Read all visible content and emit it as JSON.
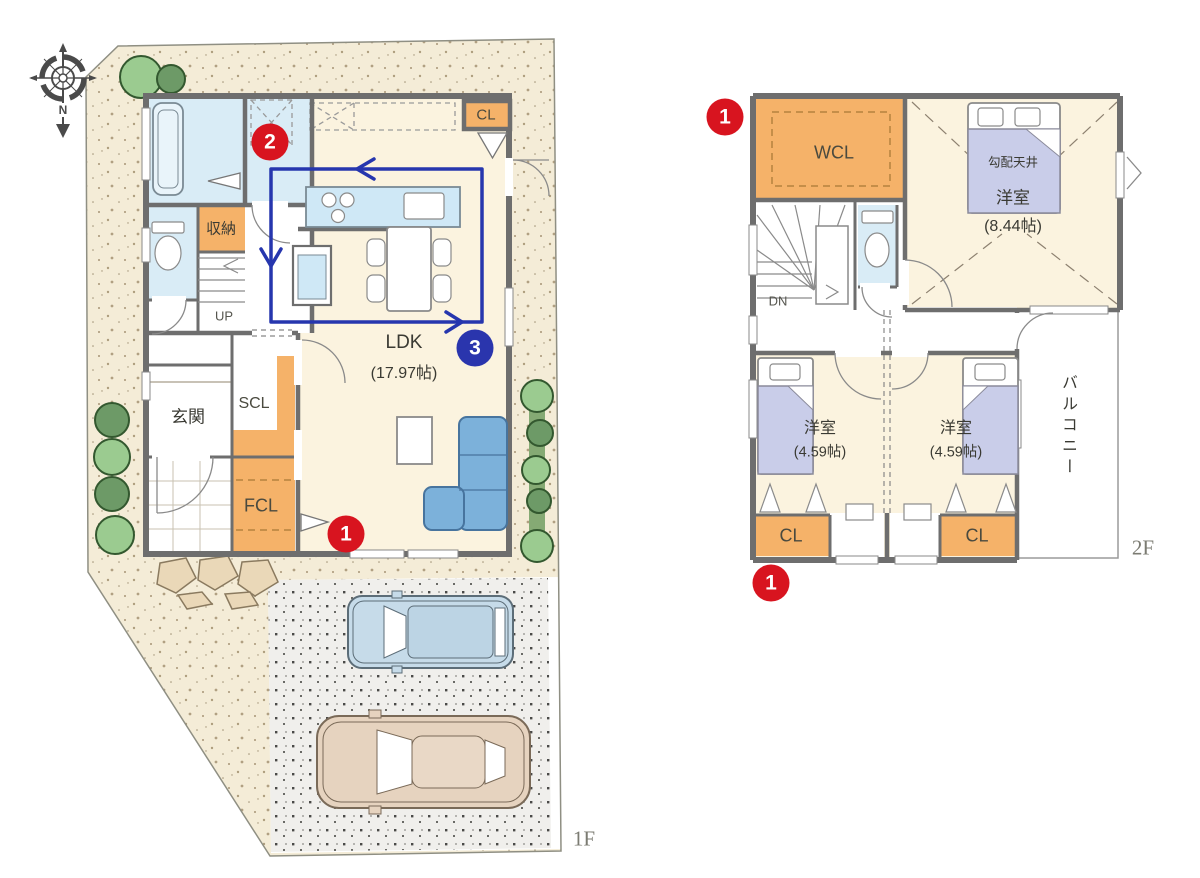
{
  "compass": {
    "north_label": "N"
  },
  "floor1": {
    "floor_label": "1F",
    "labels": {
      "storage": "収納",
      "stairs_up": "UP",
      "closet": "CL",
      "entrance": "玄関",
      "shoe_closet": "SCL",
      "family_closet": "FCL",
      "ldk_name": "LDK",
      "ldk_size": "(17.97帖)"
    },
    "markers": {
      "point1": "1",
      "point2": "2",
      "point3": "3"
    }
  },
  "floor2": {
    "floor_label": "2F",
    "labels": {
      "walkin_closet": "WCL",
      "stairs_down": "DN",
      "sloped_ceiling": "勾配天井",
      "main_bedroom_name": "洋室",
      "main_bedroom_size": "(8.44帖)",
      "bedroom_left_name": "洋室",
      "bedroom_left_size": "(4.59帖)",
      "bedroom_right_name": "洋室",
      "bedroom_right_size": "(4.59帖)",
      "closet_left": "CL",
      "closet_right": "CL",
      "balcony": "バルコニー"
    },
    "markers": {
      "point1_top": "1",
      "point1_bottom": "1"
    }
  },
  "colors": {
    "marker_red": "#d8141f",
    "marker_blue": "#2a35ad",
    "flow_path_blue": "#2636ae",
    "closet_orange": "#f5b269",
    "wet_area_blue": "#d9ecf6",
    "floor_cream": "#fbf3df",
    "site_beige": "#f4ecd7",
    "wall_gray": "#6e6e6e",
    "bed_lavender": "#c9cde9",
    "sofa_blue": "#7cb1da"
  }
}
